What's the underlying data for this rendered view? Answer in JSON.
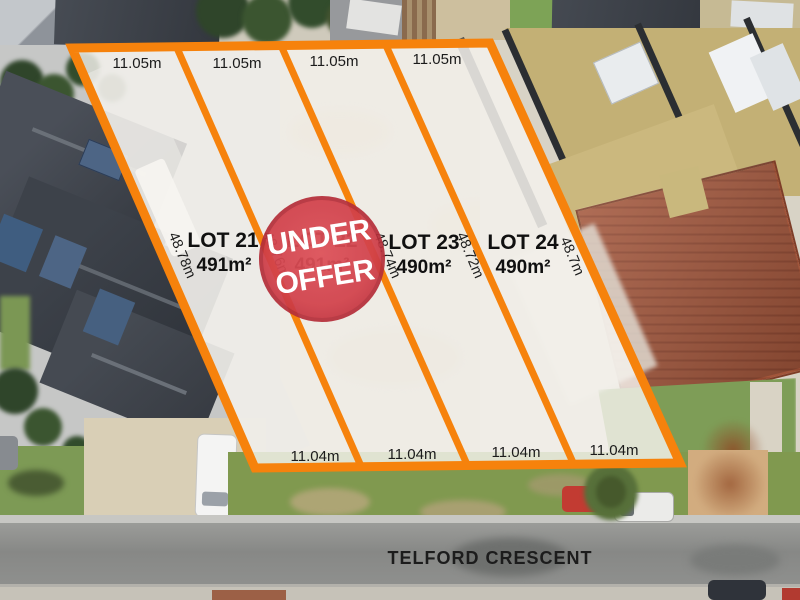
{
  "listing": {
    "street_name": "TELFORD CRESCENT",
    "status_badge": {
      "line1": "UNDER",
      "line2": "OFFER"
    },
    "lots": [
      {
        "name": "LOT 21",
        "area": "491m²",
        "top_width": "11.05m",
        "bottom_width": "11.04m"
      },
      {
        "name": "LOT 22",
        "area": "491m²",
        "top_width": "11.05m",
        "bottom_width": "11.04m",
        "status": "UNDER OFFER"
      },
      {
        "name": "LOT 23",
        "area": "490m²",
        "top_width": "11.05m",
        "bottom_width": "11.04m"
      },
      {
        "name": "LOT 24",
        "area": "490m²",
        "top_width": "11.05m",
        "bottom_width": "11.04m"
      }
    ],
    "side_boundaries": [
      {
        "length": "48.78m"
      },
      {
        "length": "48.76m"
      },
      {
        "length": "48.74m"
      },
      {
        "length": "48.72m"
      },
      {
        "length": "48.7m"
      }
    ],
    "colors": {
      "boundary": "#F6820C",
      "badge": "#D2414B",
      "badge_ring": "#B52F3A"
    }
  }
}
